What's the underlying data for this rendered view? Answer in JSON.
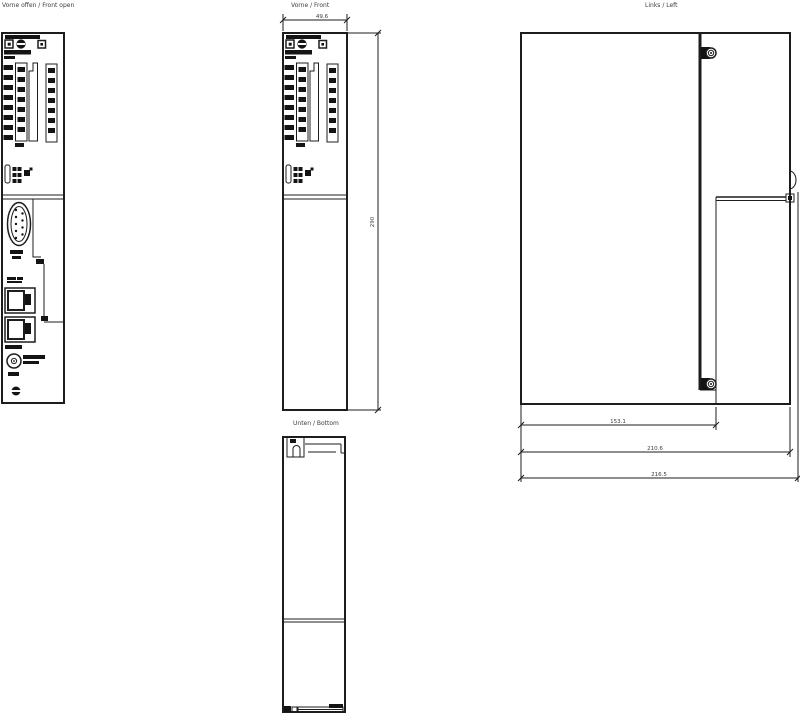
{
  "drawing": {
    "type": "mechanical-dimension-drawing",
    "background": "#ffffff",
    "line_color": "#1d1d1d",
    "text_color": "#3c3c3c"
  },
  "views": {
    "front_open": {
      "title": "Vorne offen / Front open"
    },
    "front": {
      "title": "Vorne / Front"
    },
    "left": {
      "title": "Links / Left"
    },
    "bottom": {
      "title": "Unten / Bottom"
    }
  },
  "dimensions": {
    "front_width": "49.6",
    "front_height": "290",
    "left_depth_front_section": "153.1",
    "left_depth_body": "210.6",
    "left_depth_total": "216.5"
  },
  "icons": {
    "led": "led-indicator-icon",
    "mode_selector": "mode-selector-icon",
    "backplane_blocks": "terminal-block-icon",
    "memory_slot": "memory-card-slot-icon",
    "db9": "db9-serial-connector-icon",
    "rj45": "rj45-port-icon",
    "power": "power-connector-icon",
    "screw": "slotted-screw-icon"
  }
}
